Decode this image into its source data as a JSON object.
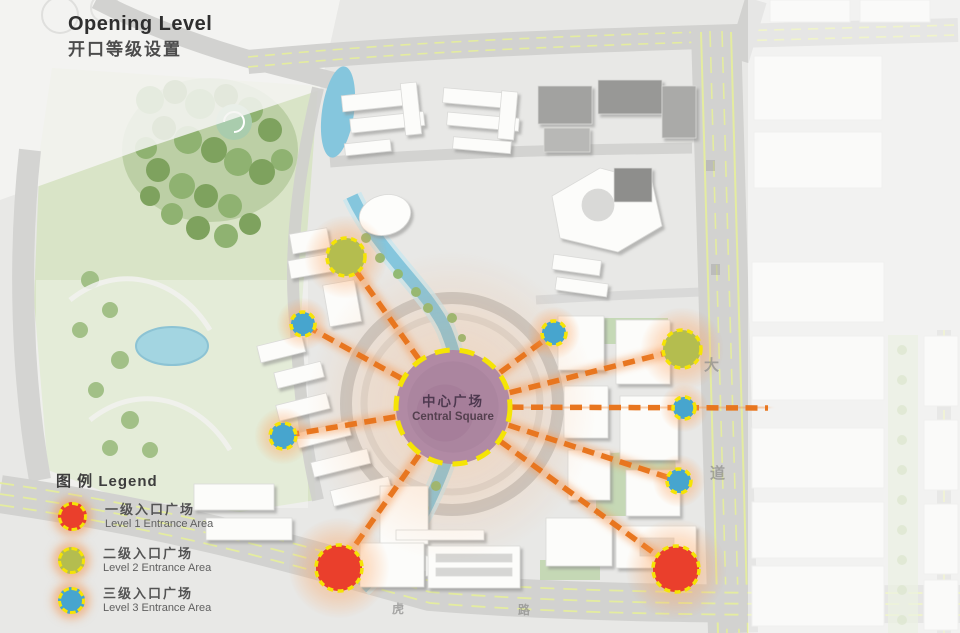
{
  "title": {
    "en": "Opening Level",
    "zh": "开口等级设置"
  },
  "central_square": {
    "zh": "中心广场",
    "en": "Central Square",
    "x": 453,
    "y": 407,
    "r": 57
  },
  "legend": {
    "heading": "图 例 Legend",
    "items": [
      {
        "level": "1",
        "zh": "一级入口广场",
        "en": "Level 1 Entrance Area",
        "color": "#ea3f2c"
      },
      {
        "level": "2",
        "zh": "二级入口广场",
        "en": "Level 2 Entrance Area",
        "color": "#b4bd4f"
      },
      {
        "level": "3",
        "zh": "三级入口广场",
        "en": "Level 3 Entrance Area",
        "color": "#47a5ce"
      }
    ]
  },
  "nodes": [
    {
      "level": "2",
      "x": 346,
      "y": 257,
      "r": 19
    },
    {
      "level": "3",
      "x": 303,
      "y": 324,
      "r": 12
    },
    {
      "level": "3",
      "x": 283,
      "y": 436,
      "r": 13
    },
    {
      "level": "1",
      "x": 339,
      "y": 568,
      "r": 23
    },
    {
      "level": "3",
      "x": 554,
      "y": 333,
      "r": 12
    },
    {
      "level": "2",
      "x": 682,
      "y": 349,
      "r": 19
    },
    {
      "level": "3",
      "x": 684,
      "y": 408,
      "r": 11
    },
    {
      "level": "3",
      "x": 679,
      "y": 481,
      "r": 12
    },
    {
      "level": "1",
      "x": 676,
      "y": 569,
      "r": 23
    }
  ],
  "rays": [
    {
      "x2": 346,
      "y2": 257
    },
    {
      "x2": 303,
      "y2": 324
    },
    {
      "x2": 283,
      "y2": 436
    },
    {
      "x2": 339,
      "y2": 568
    },
    {
      "x2": 554,
      "y2": 333
    },
    {
      "x2": 682,
      "y2": 349
    },
    {
      "x2": 768,
      "y2": 408
    },
    {
      "x2": 679,
      "y2": 481
    },
    {
      "x2": 676,
      "y2": 569
    }
  ],
  "road_labels": [
    {
      "text": "大"
    },
    {
      "text": "道"
    },
    {
      "text": "虎"
    },
    {
      "text": "路"
    }
  ],
  "colors": {
    "background": "#e8e8e6",
    "ray": "#e8761f",
    "ray_glow": "#f59a55",
    "node_border": "#f5e405",
    "square_fill": "#b18aa4",
    "levels": {
      "1": "#ea3f2c",
      "2": "#b4bd4f",
      "3": "#47a5ce"
    }
  }
}
